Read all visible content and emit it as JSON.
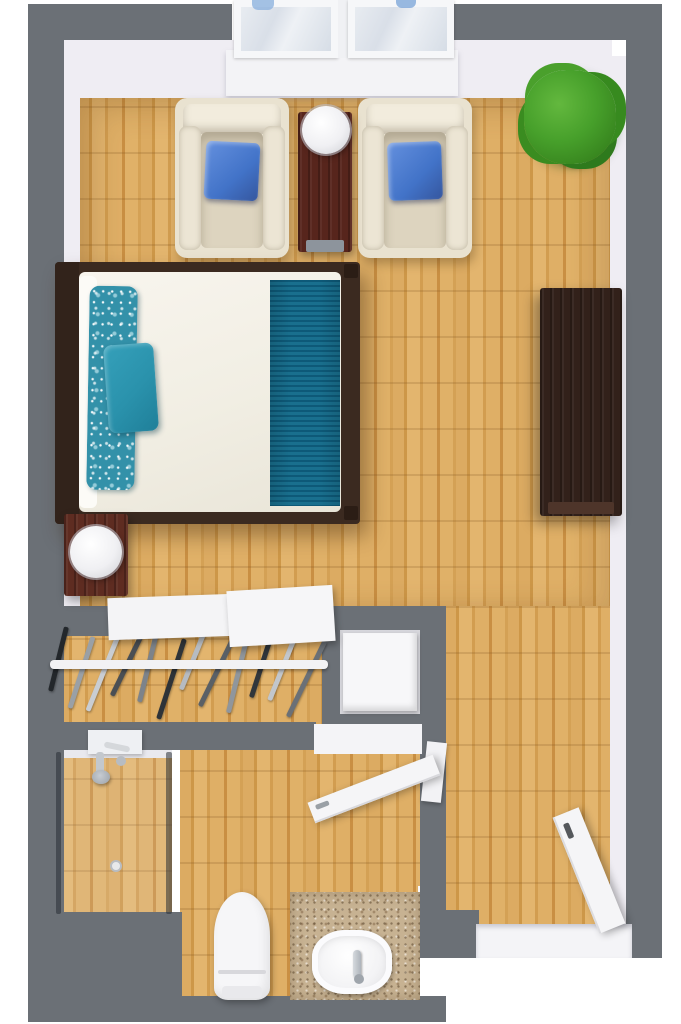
{
  "scene": {
    "title": "3D top-down floor plan of a studio apartment with bathroom",
    "type": "floor-plan"
  },
  "palette": {
    "wall_gray": "#6b7076",
    "wall_face_white": "#efedf3",
    "floor_wood": "#d7a458",
    "accent_teal": "#3391a9",
    "pillow_blue": "#4d7fd0",
    "dark_wood": "#32211a",
    "mahogany": "#5c2c20",
    "granite_beige": "#c7b292",
    "plant_green": "#3f9426",
    "fixture_white": "#f6f6f8"
  },
  "areas": {
    "main_room": {
      "label": "Main room with bed and sitting area"
    },
    "closet": {
      "label": "Open closet with hanging rod and shelves",
      "shelf_count": 2
    },
    "niche": {
      "label": "Storage niche with white cabinet"
    },
    "shower": {
      "label": "Shower stall with glass panels"
    },
    "bathroom": {
      "label": "Bathroom with toilet and vanity"
    },
    "entry": {
      "label": "Entry with open door"
    }
  },
  "furniture": {
    "window": {
      "label": "Double window",
      "panes": 2
    },
    "armchair_left": {
      "label": "Armchair with blue throw pillow"
    },
    "armchair_right": {
      "label": "Armchair with blue throw pillow"
    },
    "side_table": {
      "label": "Dark wood side table"
    },
    "table_lamp": {
      "label": "White table lamp"
    },
    "plant": {
      "label": "Potted green plant"
    },
    "bed": {
      "label": "Bed with white linens and teal bedding"
    },
    "floral_pillow": {
      "label": "Teal floral long pillow"
    },
    "accent_pillow": {
      "label": "Solid teal accent pillow"
    },
    "runner": {
      "label": "Teal striped bed runner"
    },
    "nightstand": {
      "label": "Nightstand with round lamp"
    },
    "dresser": {
      "label": "Dark wood dresser"
    },
    "shelves": {
      "label": "White closet shelves"
    },
    "rod": {
      "label": "Closet hanging rod"
    },
    "appliance": {
      "label": "White cabinet in niche"
    },
    "shower_fixture": {
      "label": "Chrome shower fixture"
    },
    "drain": {
      "label": "Shower floor drain"
    },
    "bathroom_door": {
      "label": "Open bathroom door"
    },
    "entry_door": {
      "label": "Open entry door"
    },
    "toilet": {
      "label": "Toilet"
    },
    "sink": {
      "label": "Vanity vessel sink with faucet"
    },
    "hangers": {
      "label": "Clothes hangers on rod",
      "count": 12,
      "colors": [
        "#23272b",
        "#9aa0a6",
        "#c9cdd2",
        "#4a4f54",
        "#7d838a",
        "#2e3338",
        "#b6bbc1",
        "#5a6066",
        "#90969c",
        "#31363b",
        "#c2c6cb",
        "#6b7076"
      ]
    }
  }
}
